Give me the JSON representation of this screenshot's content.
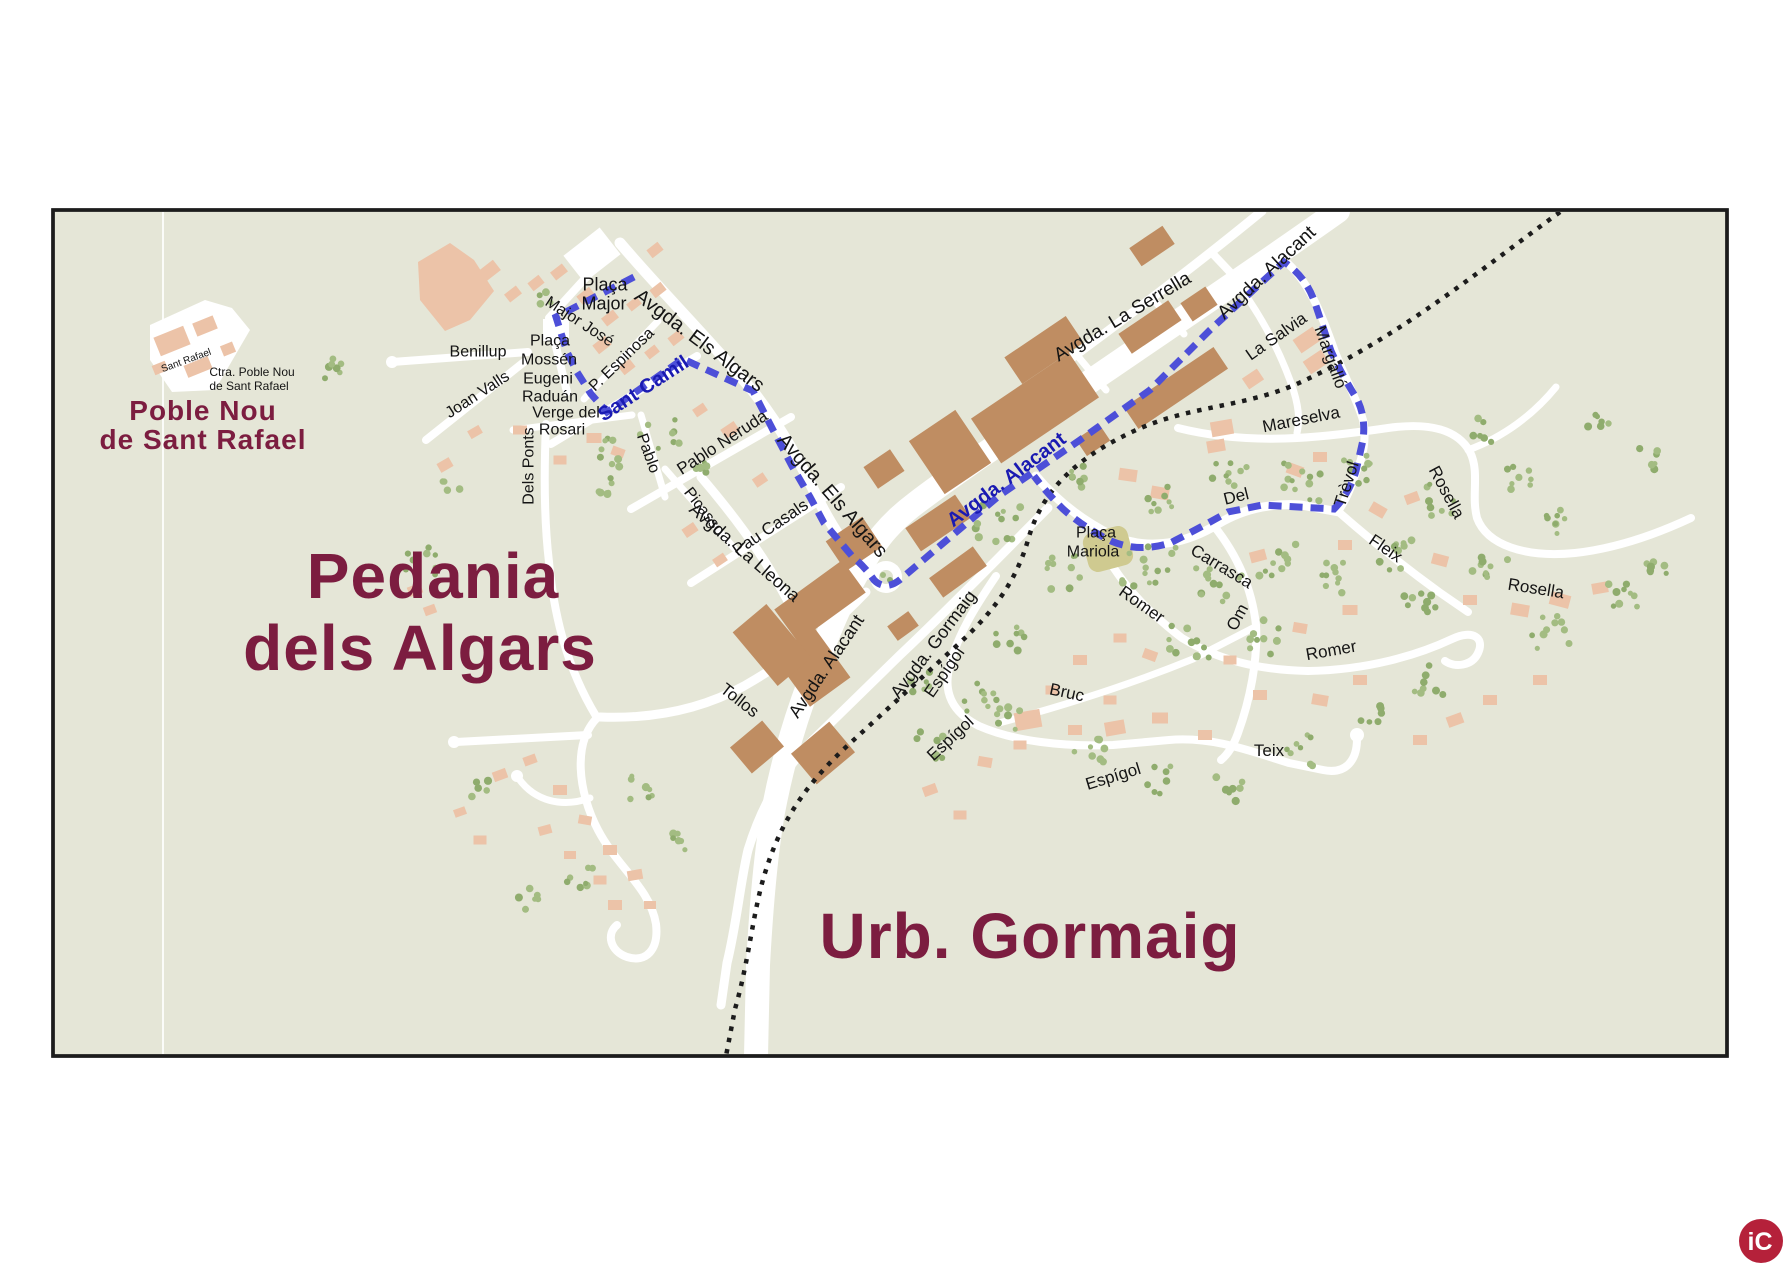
{
  "titles": {
    "region1_line1": "Poble Nou",
    "region1_line2": "de Sant Rafael",
    "region2_line1": "Pedania",
    "region2_line2": "dels Algars",
    "region3": "Urb. Gormaig"
  },
  "logo": {
    "text": "iC"
  },
  "colors": {
    "background": "#ffffff",
    "map_bg": "#e5e6d7",
    "road": "#ffffff",
    "building_dark": "#bf8d62",
    "building_light": "#ecc3a8",
    "tree": "#a3bc82",
    "tree2": "#8fac6d",
    "route_blue": "#4d4fd8",
    "route_label_blue": "#1a1ab2",
    "railway": "#1c1c1c",
    "street_label": "#141414",
    "title_maroon": "#7c1d40",
    "logo_red": "#b5213a",
    "plaza": "#cfca90"
  },
  "street_labels": [
    {
      "t": "Plaça",
      "x": 605,
      "y": 284,
      "r": 0,
      "s": 18
    },
    {
      "t": "Major",
      "x": 604,
      "y": 303,
      "r": 0,
      "s": 18
    },
    {
      "t": "Major José",
      "x": 580,
      "y": 321,
      "r": 33,
      "s": 16
    },
    {
      "t": "P. Espinosa",
      "x": 621,
      "y": 359,
      "r": -44,
      "s": 16
    },
    {
      "t": "Plaça",
      "x": 550,
      "y": 340,
      "r": 0,
      "s": 16
    },
    {
      "t": "Mossén",
      "x": 549,
      "y": 359,
      "r": 0,
      "s": 16
    },
    {
      "t": "Eugeni",
      "x": 548,
      "y": 378,
      "r": 0,
      "s": 16
    },
    {
      "t": "Raduán",
      "x": 550,
      "y": 396,
      "r": 0,
      "s": 16
    },
    {
      "t": "Verge del",
      "x": 566,
      "y": 412,
      "r": 0,
      "s": 16
    },
    {
      "t": "Rosari",
      "x": 562,
      "y": 429,
      "r": 0,
      "s": 16
    },
    {
      "t": "Benillup",
      "x": 478,
      "y": 351,
      "r": 0,
      "s": 16
    },
    {
      "t": "Joan Valls",
      "x": 477,
      "y": 394,
      "r": -33,
      "s": 16
    },
    {
      "t": "Dels Ponts",
      "x": 528,
      "y": 466,
      "r": -90,
      "s": 16
    },
    {
      "t": "Sant Camil",
      "x": 643,
      "y": 388,
      "r": -33,
      "s": 20,
      "c": "blue"
    },
    {
      "t": "Avgda. Els Algars",
      "x": 700,
      "y": 340,
      "r": 37,
      "s": 20
    },
    {
      "t": "Avgda. Els Algars",
      "x": 833,
      "y": 495,
      "r": 49,
      "s": 20
    },
    {
      "t": "Pablo",
      "x": 649,
      "y": 453,
      "r": 70,
      "s": 16
    },
    {
      "t": "Pablo Neruda",
      "x": 722,
      "y": 442,
      "r": -33,
      "s": 17
    },
    {
      "t": "Picasso",
      "x": 705,
      "y": 511,
      "r": 52,
      "s": 16
    },
    {
      "t": "Pau Casals",
      "x": 770,
      "y": 527,
      "r": -34,
      "s": 17
    },
    {
      "t": "Avgda. La Lleona",
      "x": 745,
      "y": 552,
      "r": 41,
      "s": 18
    },
    {
      "t": "Tollos",
      "x": 740,
      "y": 700,
      "r": 38,
      "s": 17
    },
    {
      "t": "Avgda. Alacant",
      "x": 826,
      "y": 666,
      "r": -56,
      "s": 18
    },
    {
      "t": "Avgda. Alacant",
      "x": 1266,
      "y": 272,
      "r": -43,
      "s": 19
    },
    {
      "t": "Avgda. Alacant",
      "x": 1006,
      "y": 479,
      "r": -37,
      "s": 20,
      "c": "blue"
    },
    {
      "t": "Avgda. Gormaig",
      "x": 933,
      "y": 644,
      "r": -53,
      "s": 18
    },
    {
      "t": "Avgda. La Serrella",
      "x": 1122,
      "y": 316,
      "r": -31,
      "s": 19
    },
    {
      "t": "La Salvia",
      "x": 1276,
      "y": 336,
      "r": -35,
      "s": 17
    },
    {
      "t": "Margalló",
      "x": 1331,
      "y": 357,
      "r": 70,
      "s": 17
    },
    {
      "t": "Mareselva",
      "x": 1301,
      "y": 419,
      "r": -11,
      "s": 17
    },
    {
      "t": "Trèvol",
      "x": 1346,
      "y": 484,
      "r": -72,
      "s": 17
    },
    {
      "t": "Del",
      "x": 1236,
      "y": 496,
      "r": -14,
      "s": 17
    },
    {
      "t": "Carrasca",
      "x": 1222,
      "y": 566,
      "r": 31,
      "s": 17
    },
    {
      "t": "Fleix",
      "x": 1386,
      "y": 548,
      "r": 34,
      "s": 17
    },
    {
      "t": "Rosella",
      "x": 1447,
      "y": 492,
      "r": 62,
      "s": 17
    },
    {
      "t": "Rosella",
      "x": 1536,
      "y": 588,
      "r": 9,
      "s": 17
    },
    {
      "t": "Romer",
      "x": 1142,
      "y": 604,
      "r": 35,
      "s": 17
    },
    {
      "t": "Om",
      "x": 1237,
      "y": 617,
      "r": -62,
      "s": 17
    },
    {
      "t": "Romer",
      "x": 1331,
      "y": 650,
      "r": -10,
      "s": 17
    },
    {
      "t": "Bruc",
      "x": 1067,
      "y": 692,
      "r": 12,
      "s": 17
    },
    {
      "t": "Espígol",
      "x": 944,
      "y": 672,
      "r": -55,
      "s": 17
    },
    {
      "t": "Espígol",
      "x": 950,
      "y": 738,
      "r": -43,
      "s": 17
    },
    {
      "t": "Espígol",
      "x": 1113,
      "y": 776,
      "r": -17,
      "s": 17
    },
    {
      "t": "Teix",
      "x": 1269,
      "y": 750,
      "r": 0,
      "s": 17
    },
    {
      "t": "Plaça",
      "x": 1096,
      "y": 532,
      "r": 0,
      "s": 16
    },
    {
      "t": "Mariola",
      "x": 1093,
      "y": 551,
      "r": 0,
      "s": 16
    },
    {
      "t": "Sant Rafael",
      "x": 186,
      "y": 360,
      "r": -20,
      "s": 10
    },
    {
      "t": "Ctra. Poble Nou",
      "x": 252,
      "y": 372,
      "r": 0,
      "s": 12
    },
    {
      "t": "de Sant Rafael",
      "x": 249,
      "y": 386,
      "r": 0,
      "s": 12
    }
  ]
}
